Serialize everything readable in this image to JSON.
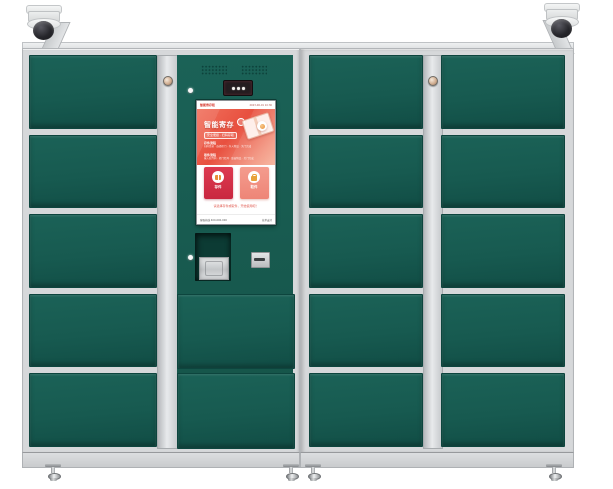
{
  "scene": {
    "description": "Smart parcel locker cabinet with dome security cameras",
    "units": 2
  },
  "colors": {
    "door_green": "#175a50",
    "frame_gray": "#d6d8da",
    "screen_banner_red": "#e8503f",
    "action_primary_red": "#c92740",
    "action_secondary_pink": "#ee8577",
    "accent_orange": "#e8903a",
    "camera_dome": "#26262b"
  },
  "left_unit": {
    "door_count": 5,
    "control_door_count": 2,
    "lock": "cylinder-lock",
    "leds": 2
  },
  "right_unit": {
    "column_a_door_count": 5,
    "column_b_door_count": 5,
    "lock": "cylinder-lock"
  },
  "screen": {
    "header": {
      "brand": "智能寄存柜",
      "status": "2023-06-01 10:30"
    },
    "banner": {
      "title": "智能寄存",
      "tag": "安全便捷 · 扫码存取",
      "groups": [
        {
          "label": "存件流程",
          "line": "扫码登录 · 选择柜门 · 存入物品 · 关门完成"
        },
        {
          "label": "取件流程",
          "line": "输入取件码 · 柜门打开 · 取出物品 · 关门完成"
        }
      ]
    },
    "actions": [
      {
        "label": "存件",
        "icon": "deposit-package-icon"
      },
      {
        "label": "取件",
        "icon": "pickup-lock-icon"
      }
    ],
    "hint": "请选择存件或取件，开始使用吧！",
    "footer": {
      "left": "客服热线 400-000-000",
      "right": "技术支持"
    }
  },
  "hardware": {
    "cameras": [
      {
        "side": "left",
        "type": "dome-camera"
      },
      {
        "side": "right",
        "type": "dome-camera"
      }
    ],
    "modules": [
      "speaker-grille",
      "scanner-camera-module",
      "drop-compartment",
      "metal-plate",
      "card-slot"
    ],
    "feet_count": 4
  }
}
